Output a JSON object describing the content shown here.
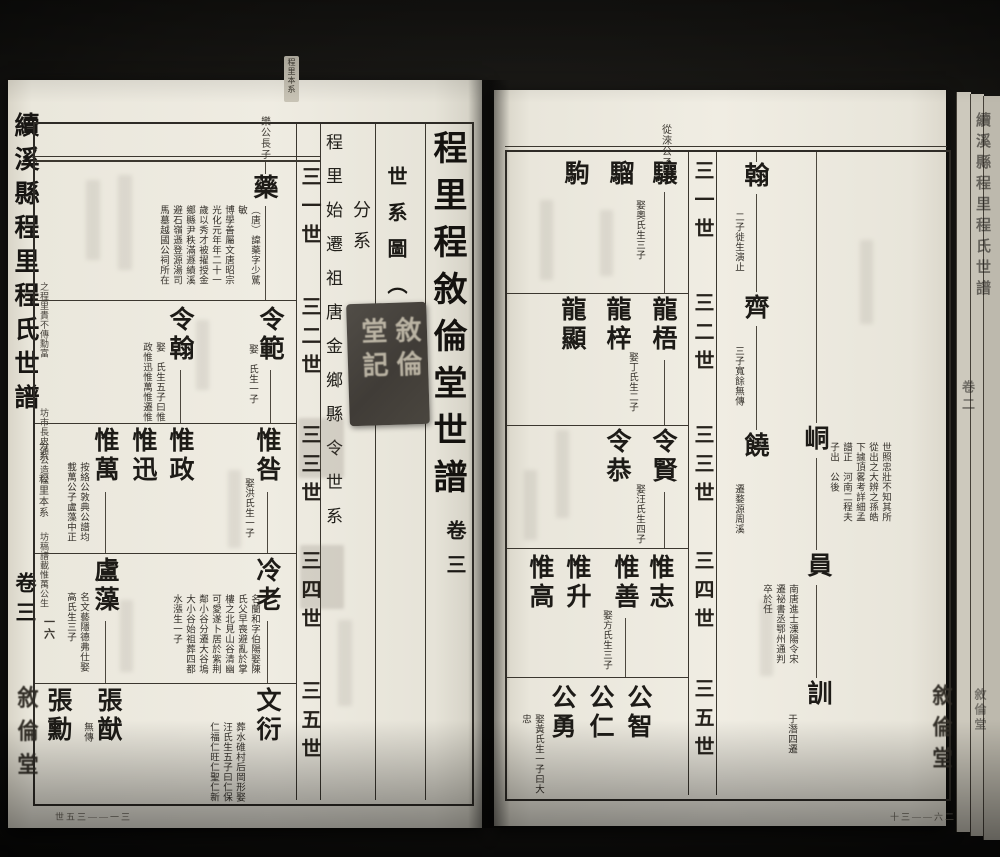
{
  "book": {
    "spine_title": "續溪縣程里程氏世譜",
    "spine_volume": "卷三",
    "spine_section": "分系",
    "spine_subsection": "程里本系",
    "page_number": "一六",
    "hall_mark": "敘倫堂",
    "top_edge_label": "程里本系",
    "fold_range_left": "世五三——一三",
    "fold_range_right": "十三——六二",
    "edge_spine_title": "續溪縣程里程氏世譜",
    "edge_volume": "卷二",
    "edge_hall": "敘倫堂"
  },
  "title_block": {
    "main_title": "程里程敘倫堂世譜",
    "volume": "卷三",
    "chart_label": "世系圖（三）",
    "branch_label": "分系",
    "lineage_heading": "程里始遷祖唐金鄉縣令世系",
    "seal_text": "敘倫堂記"
  },
  "generations": [
    "三一世",
    "三二世",
    "三三世",
    "三四世",
    "三五世"
  ],
  "left": {
    "header_label": "樂公長子",
    "margin_notes": [
      "之程里貴不傳勳富",
      "坊市長史通公造公",
      "坊稿譜載惟萬公生"
    ],
    "nodes": {
      "yao": {
        "name": "藥",
        "note": "（唐）諱藥字少騭敏\n博學善屬文唐昭宗\n光化元年年二十一\n歲以秀才被擢授金\n鄉縣尹秩滿遯績溪\n避石嶺遜登源湯司\n馬墓越國公祠所在"
      },
      "lingfan": {
        "name": "令範",
        "note": "娶　氏生一子"
      },
      "linghan": {
        "name": "令翰",
        "note": "娶　氏生五子曰惟\n政惟迅惟萬惟遷惟"
      },
      "weijiu": {
        "name": "惟咎",
        "note": "娶洪氏生一子"
      },
      "weizheng": {
        "name": "惟政"
      },
      "weixun": {
        "name": "惟迅"
      },
      "weiwan": {
        "name": "惟萬",
        "note": "按絡公敦典公譜均\n載萬公子盧藻中正"
      },
      "lenglao": {
        "name": "冷老",
        "note": "名蘭和字伯陽娶陳\n氏父早喪避亂於掌\n樓之北見山谷清幽\n可愛遂卜居於紫荆\n鄰小谷分遷大谷塢\n大小谷始祖葬四都\n水漲生一子"
      },
      "luzao": {
        "name": "盧藻",
        "note": "名文藝隱德弗仕娶\n高氏生三子"
      },
      "wenyan": {
        "name": "文衍",
        "note": "葬水碓村后岡形娶\n汪氏生五子曰仁保\n仁福仁旺仁聖仁新"
      },
      "zhangyou": {
        "name": "張猷",
        "note": "無傳"
      },
      "zhangxun": {
        "name": "張勳"
      }
    }
  },
  "right": {
    "header_label": "從淶公子",
    "nodes": {
      "tong": {
        "name": "峒",
        "note": "世照忠壯不知其所\n從出之大辨之孫皓\n下據頂畧考詳細孟\n譜正　河南二程夫\n子出　公後"
      },
      "yuan": {
        "name": "員",
        "note": "南唐進士溧陽令宋\n遷祕書丞鄂州通判\n卒於任"
      },
      "xun": {
        "name": "訓",
        "note": "于潛四遷"
      },
      "han": {
        "name": "翰",
        "note": "二子徙生演止"
      },
      "qi": {
        "name": "齊",
        "note": "三子寬餘無傳"
      },
      "rao": {
        "name": "饒",
        "note": "遷婺源周溪"
      },
      "xiang": {
        "name": "驤",
        "note": "娶奧氏生三子"
      },
      "liu": {
        "name": "騮"
      },
      "ju": {
        "name": "駒"
      },
      "longwu": {
        "name": "龍梧",
        "note": "娶丁氏生二子"
      },
      "longzi": {
        "name": "龍梓"
      },
      "longxian": {
        "name": "龍顯"
      },
      "lingxian": {
        "name": "令賢",
        "note": "娶汪氏生四子"
      },
      "linggong": {
        "name": "令恭"
      },
      "weizhi": {
        "name": "惟志"
      },
      "weishan": {
        "name": "惟善",
        "note": "娶方氏生三子"
      },
      "weisheng": {
        "name": "惟升"
      },
      "weigao": {
        "name": "惟高"
      },
      "gongzhi": {
        "name": "公智"
      },
      "gongren": {
        "name": "公仁"
      },
      "gongyong": {
        "name": "公勇",
        "note": "娶黃氏生一子曰大\n忠"
      }
    }
  }
}
